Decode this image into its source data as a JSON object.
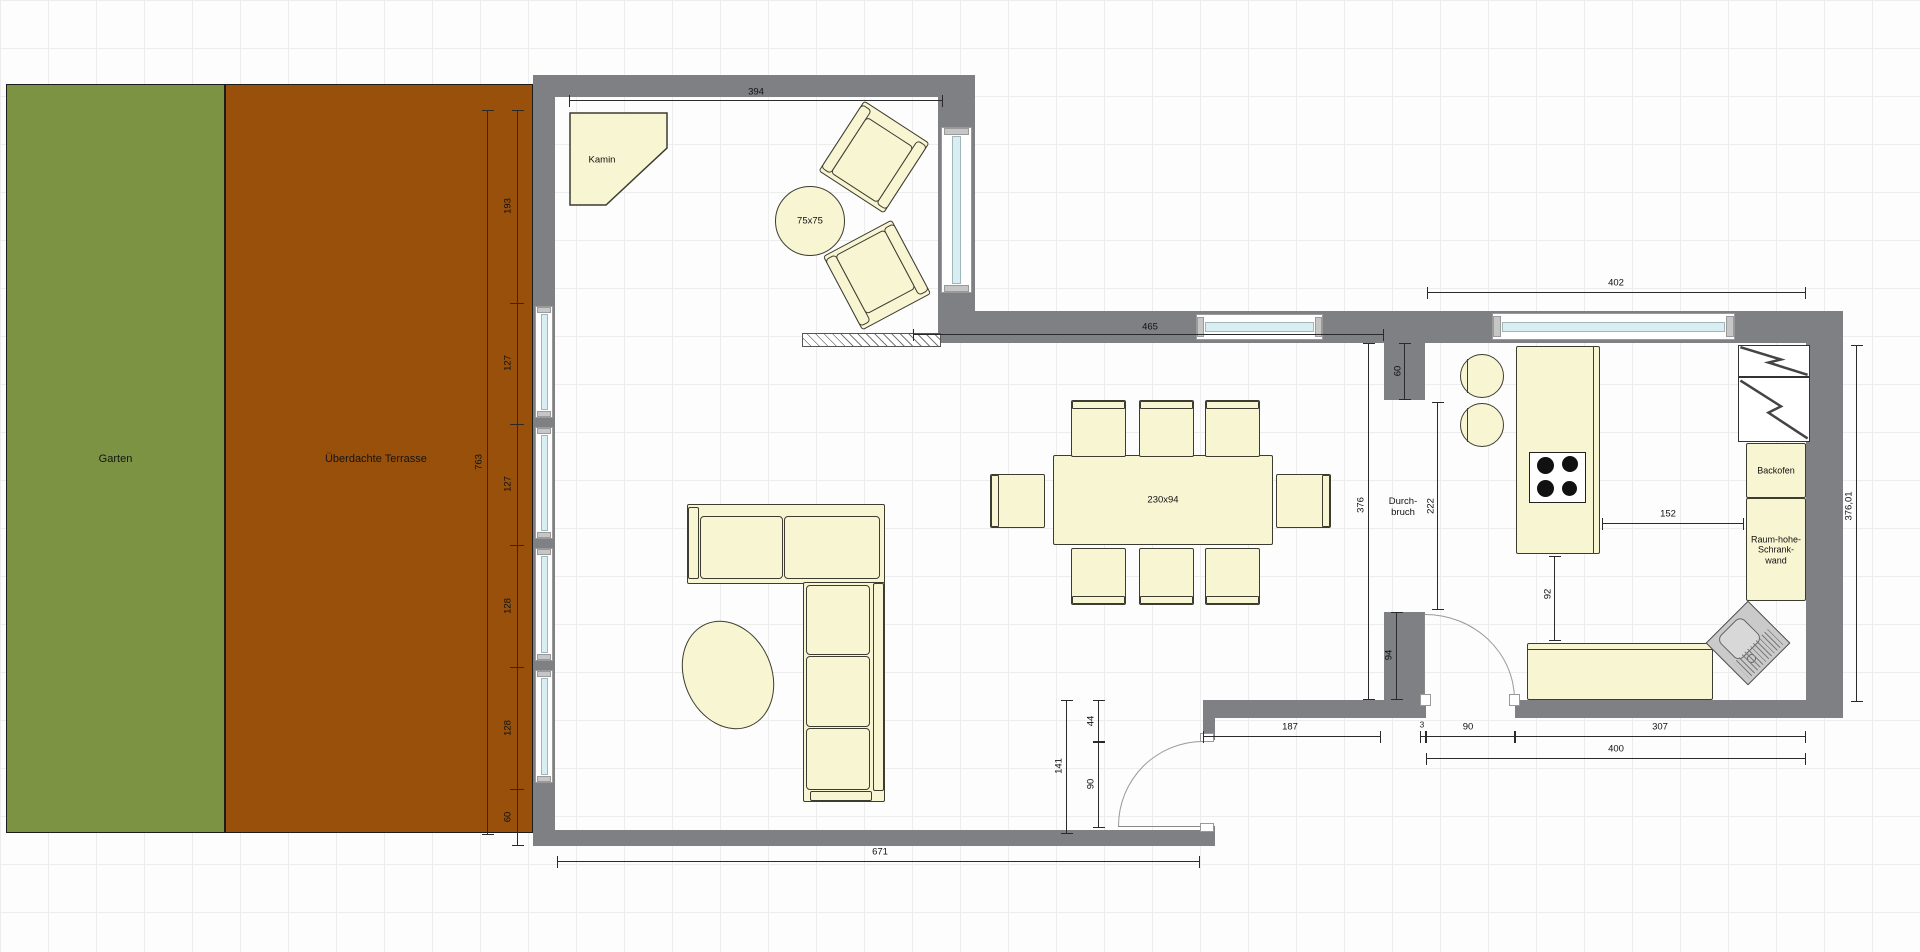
{
  "areas": {
    "garden": {
      "label": "Garten",
      "color": "#7b9343"
    },
    "terrace": {
      "label": "Überdachte Terrasse",
      "color": "#98500a"
    }
  },
  "furniture": {
    "fireplace_label": "Kamin",
    "side_table_label": "75x75",
    "dining_table_label": "230x94",
    "oven_label": "Backofen",
    "tall_cabinet_line1": "Raum-hohe-",
    "tall_cabinet_line2": "Schrank-",
    "tall_cabinet_line3": "wand"
  },
  "opening": {
    "line1": "Durch-",
    "line2": "bruch"
  },
  "dimensions": {
    "alcove_width": "394",
    "terrace_total_height": "763",
    "left_seg_top": "193",
    "left_seg_2": "127",
    "left_seg_3": "127",
    "left_seg_4": "128",
    "left_seg_5": "128",
    "left_seg_bottom": "60",
    "living_width": "671",
    "north_wall_width": "465",
    "kitchen_width": "402",
    "kitchen_left_height": "376",
    "kitchen_left_top": "60",
    "opening_height": "222",
    "kitchen_left_bottom": "94",
    "kitchen_right_height": "376,01",
    "island_to_wall": "152",
    "island_to_counter": "92",
    "living_door_offset": "44",
    "living_door_width": "90",
    "living_door_total": "141",
    "bottom_run": "187",
    "kitchen_door_gap": "3",
    "kitchen_door_width": "90",
    "counter_run": "307",
    "kitchen_bottom_total": "400"
  },
  "colors": {
    "wall": "#7e8083",
    "furniture_fill": "#f8f5d3",
    "glass": "#d9eef3",
    "garden": "#7b9343",
    "terrace": "#98500a",
    "sink": "#cacaca"
  }
}
